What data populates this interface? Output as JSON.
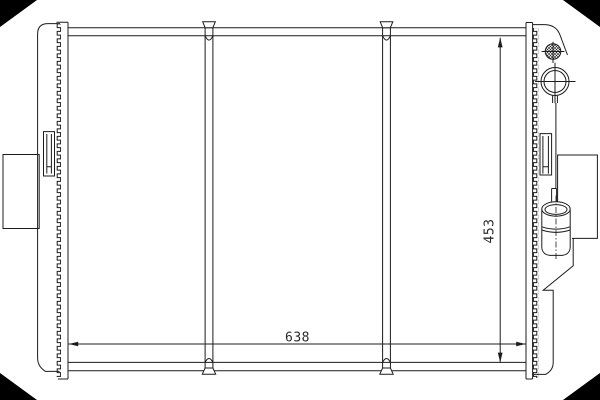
{
  "meta": {
    "background_color": "#ffffff",
    "line_color": "#1c1c1c",
    "corner_mark_color": "#000000"
  },
  "drawing": {
    "type": "radiator-technical-line-drawing",
    "dimensions": {
      "width_label": "638",
      "height_label": "453"
    }
  }
}
